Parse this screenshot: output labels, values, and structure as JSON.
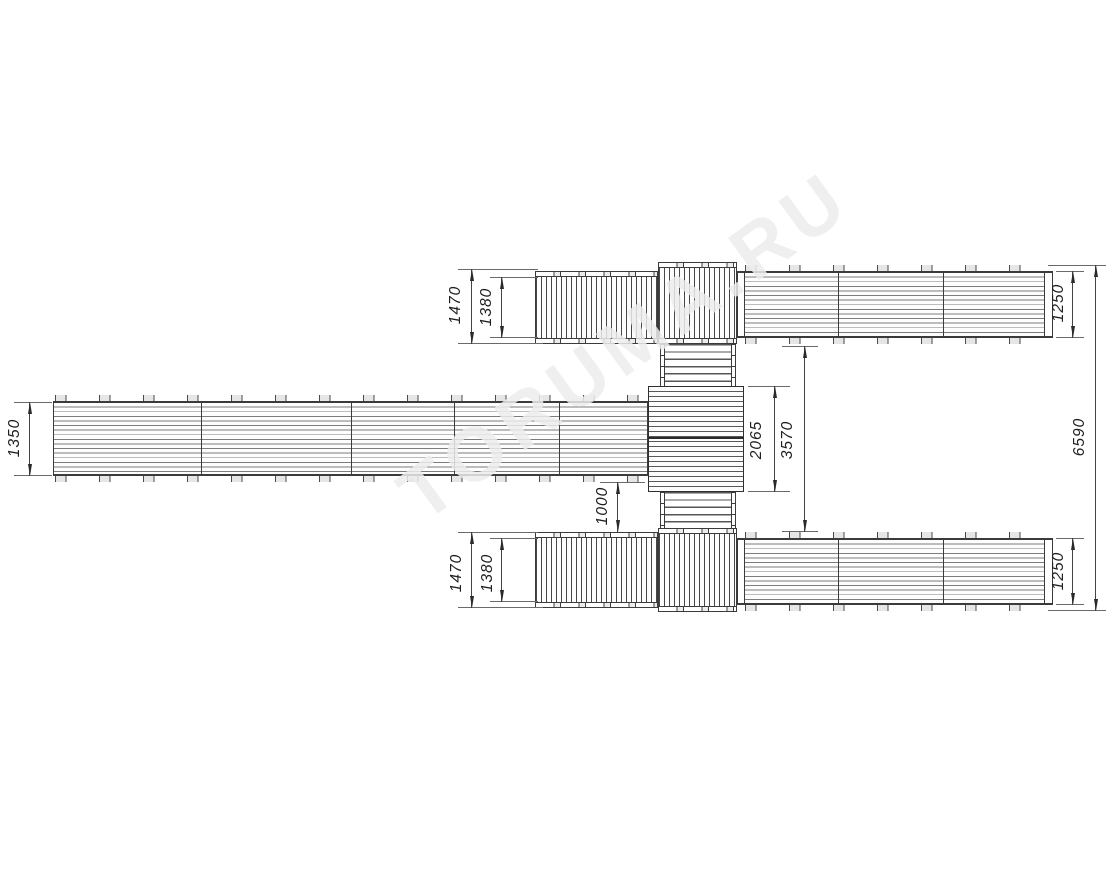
{
  "watermark": {
    "text": "TORUMA.RU"
  },
  "dimensions": {
    "top_bridge_outer": "1470",
    "top_bridge_inner": "1380",
    "top_right_walkway_width": "1250",
    "overall_height": "6590",
    "left_walkway_width": "1350",
    "central_platform_height": "2065",
    "right_walkways_gap": "3570",
    "walkway_to_bridge_gap": "1000",
    "bottom_bridge_outer": "1470",
    "bottom_bridge_inner": "1380",
    "bottom_right_walkway_width": "1250"
  },
  "colors": {
    "background": "#ffffff",
    "line": "#3b3b3b",
    "dimension": "#2a2a2a",
    "watermark": "#ececec"
  }
}
